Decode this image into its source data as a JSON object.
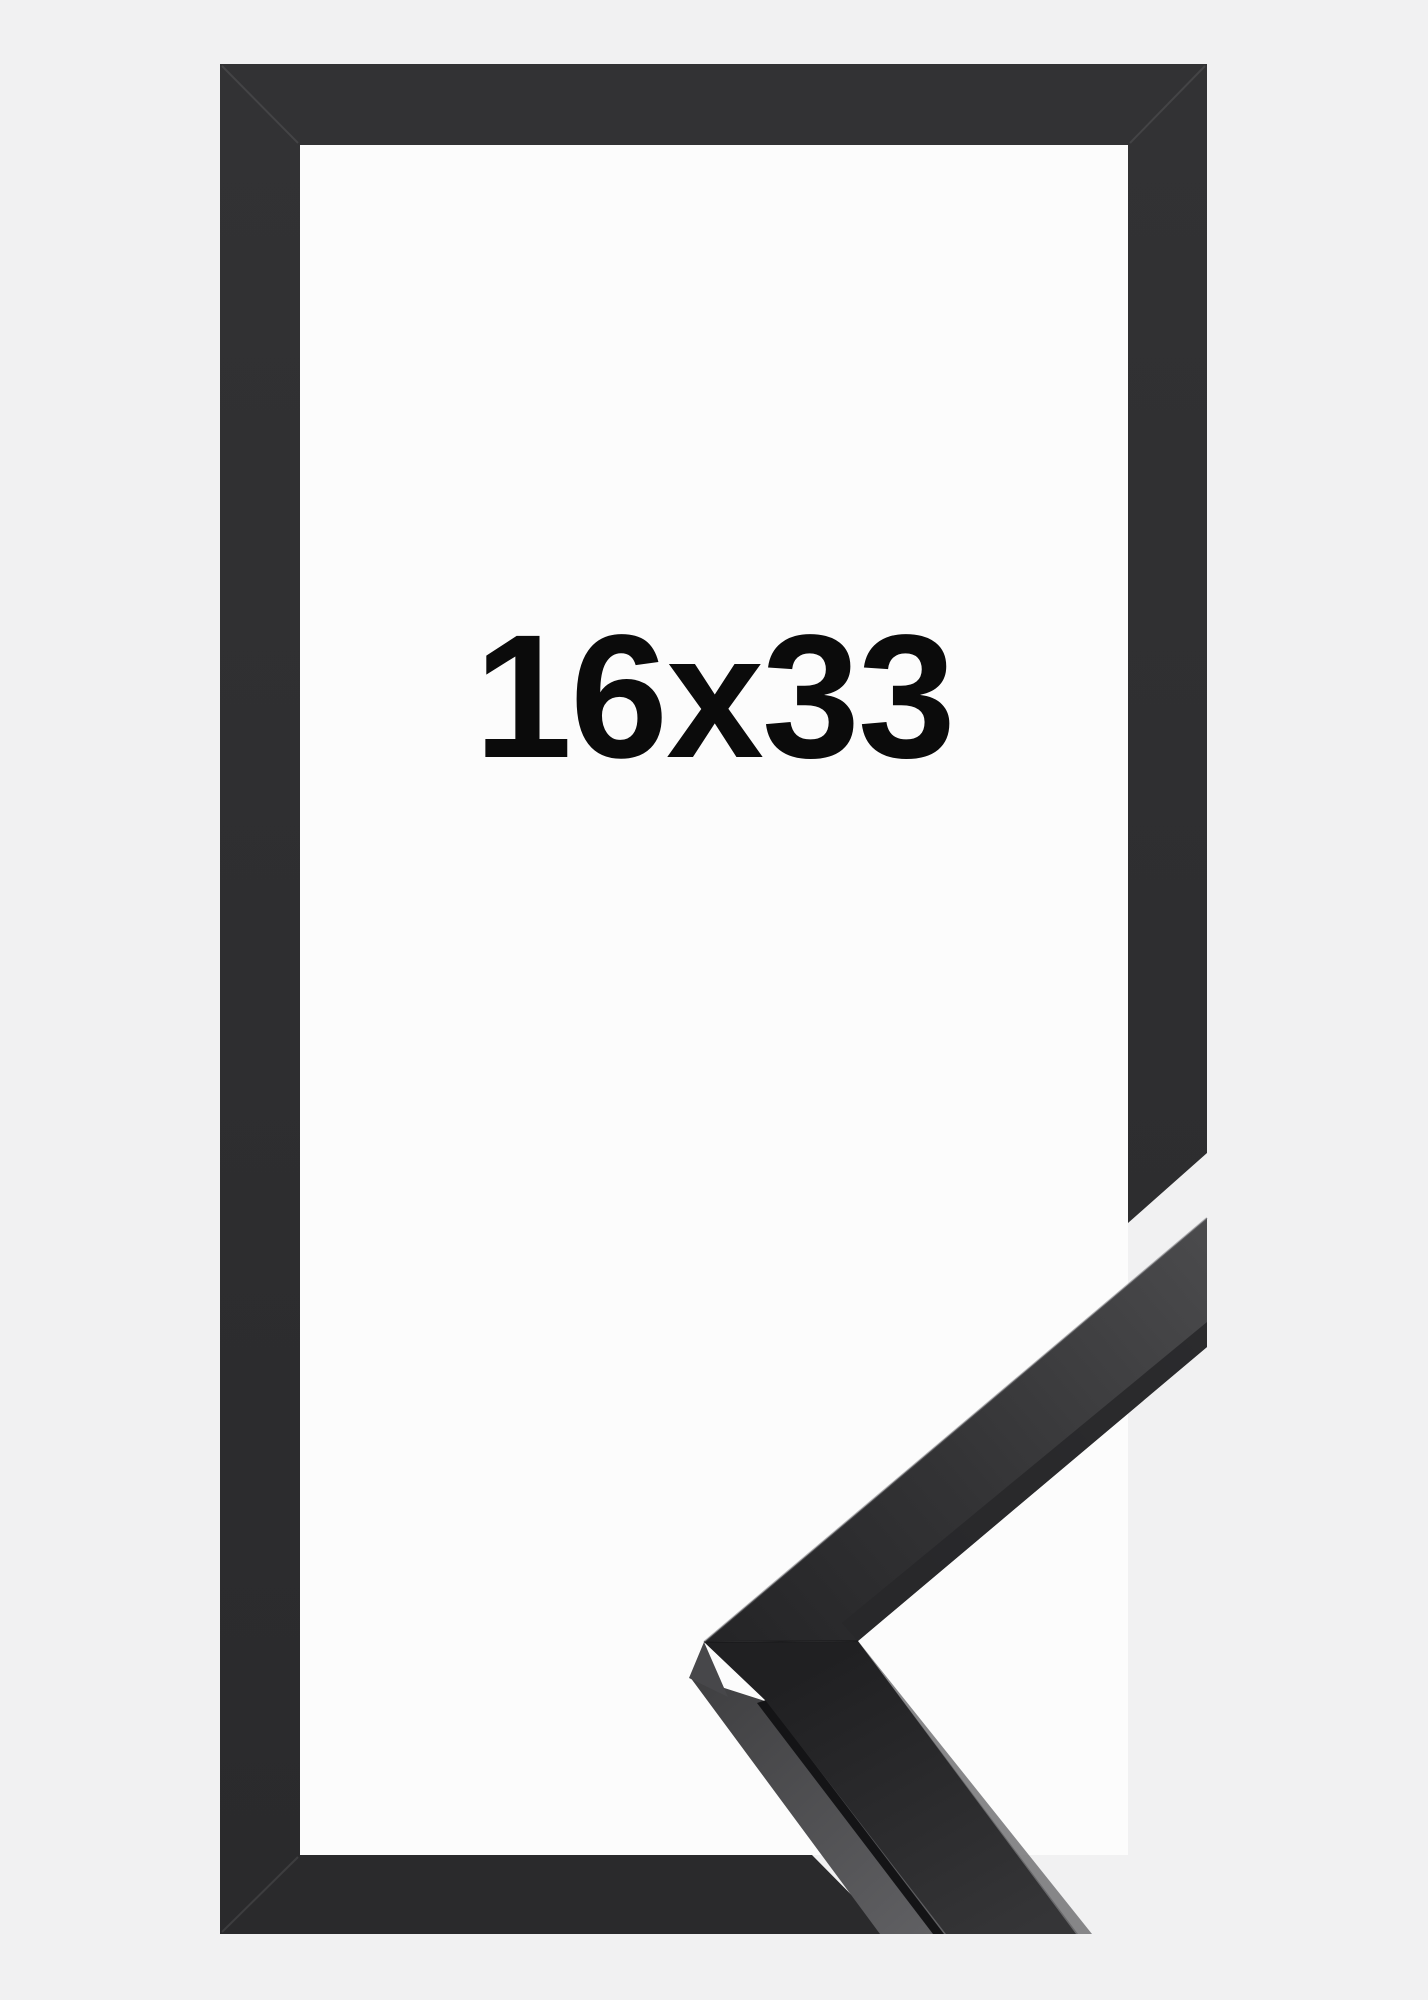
{
  "image": {
    "kind": "product-photo",
    "subject": "black picture frame with cut-away corner profile sample",
    "size_label": "16x33"
  },
  "colors": {
    "background": "#f1f1f2",
    "mat": "#fcfcfc",
    "frame": "#2e2e30",
    "label_text": "#0b0b0b",
    "profile_face_dark": "#242426",
    "profile_face_light": "#4b4b4d",
    "profile_side_light": "#616164",
    "profile_groove": "#141416",
    "profile_edge_highlight": "#737376"
  }
}
